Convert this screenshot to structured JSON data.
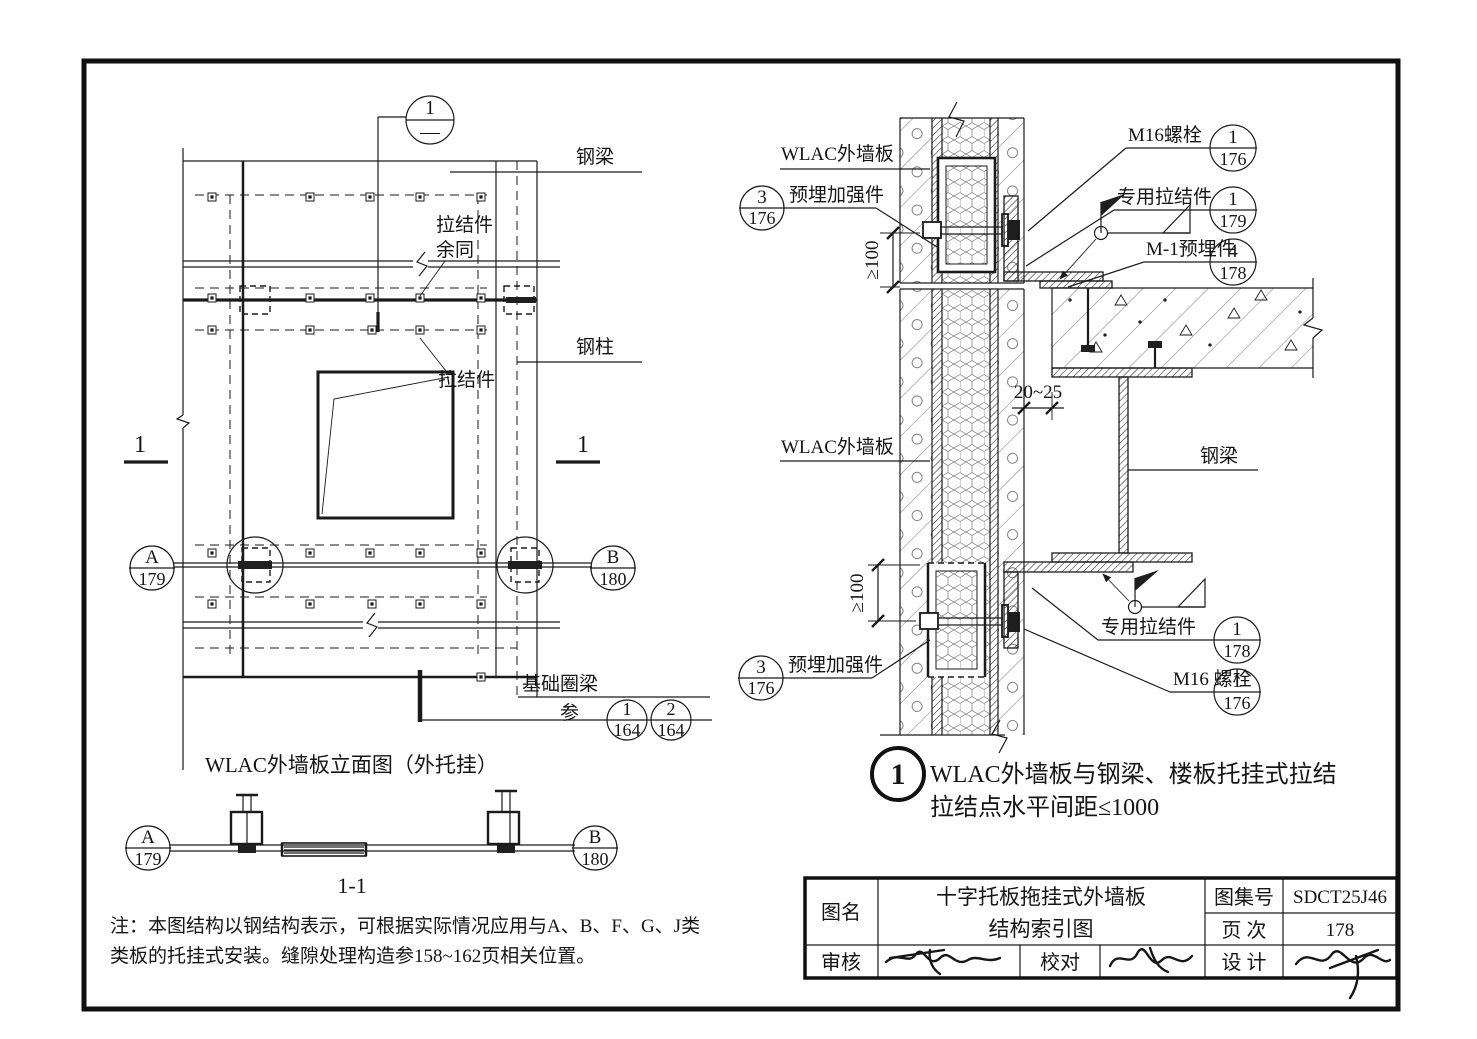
{
  "elevation": {
    "callout_top": {
      "num": "1",
      "den": "—"
    },
    "labels": {
      "steel_beam": "钢梁",
      "tie1a": "拉结件",
      "tie1b": "余同",
      "tie2": "拉结件",
      "steel_column": "钢柱",
      "foundation": "基础圈梁",
      "ref": "参",
      "sec_left": "1",
      "sec_right": "1"
    },
    "axis_a": {
      "num": "A",
      "den": "179"
    },
    "axis_b": {
      "num": "B",
      "den": "180"
    },
    "ref1": {
      "num": "1",
      "den": "164"
    },
    "ref2": {
      "num": "2",
      "den": "164"
    },
    "title": "WLAC外墙板立面图（外托挂）"
  },
  "section11": {
    "axis_a": {
      "num": "A",
      "den": "179"
    },
    "axis_b": {
      "num": "B",
      "den": "180"
    },
    "title": "1-1"
  },
  "detail": {
    "labels": {
      "panel_top": "WLAC外墙板",
      "embed_top": "预埋加强件",
      "m16_top": "M16螺栓",
      "tie_top": "专用拉结件",
      "m1_plate": "M-1预埋件",
      "beam": "钢梁",
      "panel_mid": "WLAC外墙板",
      "tie_bot": "专用拉结件",
      "m16_bot": "M16 螺栓",
      "embed_bot": "预埋加强件"
    },
    "callouts": {
      "embed_top": {
        "num": "3",
        "den": "176"
      },
      "m16_top": {
        "num": "1",
        "den": "176"
      },
      "tie_top": {
        "num": "1",
        "den": "179"
      },
      "m1": {
        "num": "4",
        "den": "178"
      },
      "tie_bot": {
        "num": "1",
        "den": "178"
      },
      "m16_bot": {
        "num": "1",
        "den": "176"
      },
      "embed_bot": {
        "num": "3",
        "den": "176"
      }
    },
    "dims": {
      "ge100_top": "≥100",
      "ge100_bot": "≥100",
      "gap": "20~25"
    },
    "caption": {
      "num": "1",
      "line1": "WLAC外墙板与钢梁、楼板托挂式拉结",
      "line2": "拉结点水平间距≤1000"
    }
  },
  "notes": {
    "line1": "注：本图结构以钢结构表示，可根据实际情况应用与A、B、F、G、J类",
    "line2": "类板的托挂式安装。缝隙处理构造参158~162页相关位置。"
  },
  "title_block": {
    "name_label": "图名",
    "name1": "十字托板拖挂式外墙板",
    "name2": "结构索引图",
    "atlas_label": "图集号",
    "atlas_no": "SDCT25J46",
    "page_label": "页 次",
    "page_no": "178",
    "review": "审核",
    "proof": "校对",
    "design": "设 计"
  }
}
